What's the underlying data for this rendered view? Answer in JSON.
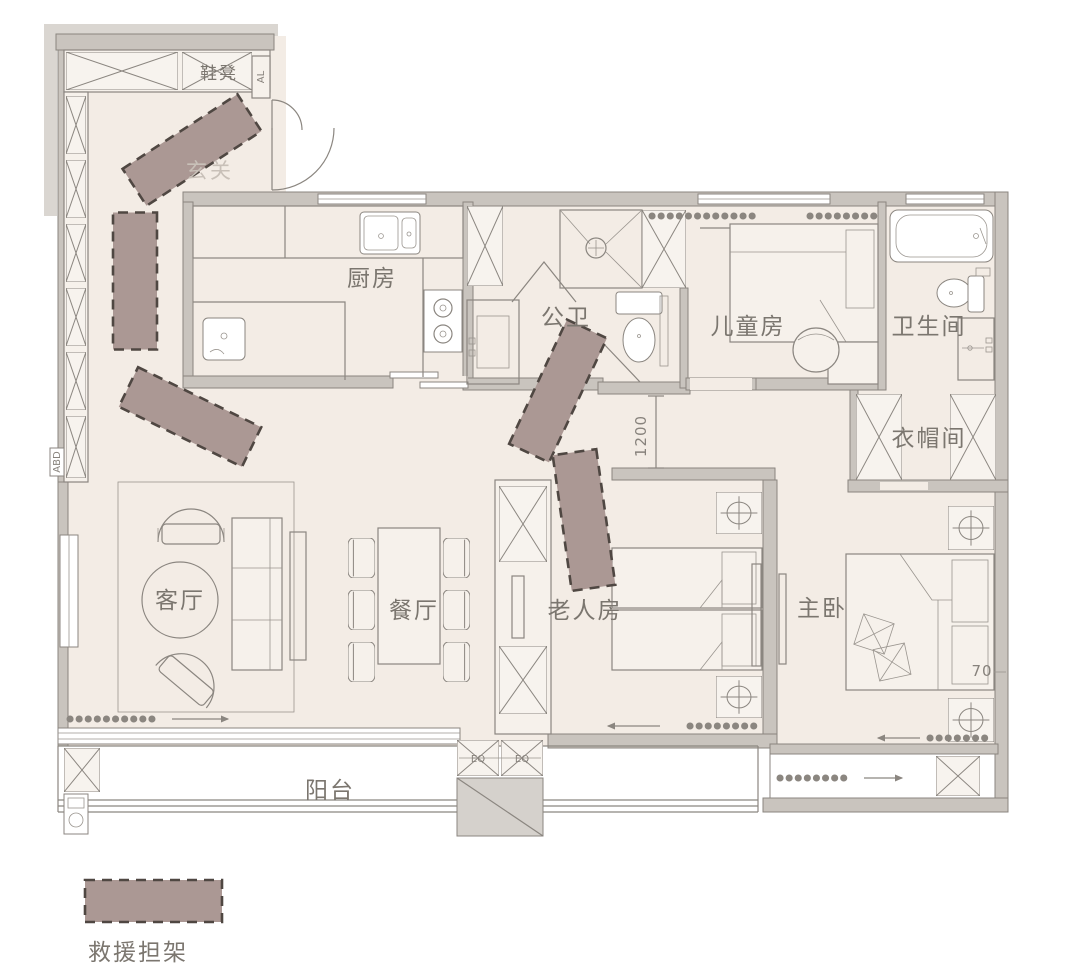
{
  "rooms": {
    "entry": "玄关",
    "shoe_bench": "鞋凳",
    "kitchen": "厨房",
    "guest_bath": "公卫",
    "kids_room": "儿童房",
    "bathroom": "卫生间",
    "cloakroom": "衣帽间",
    "living_room": "客厅",
    "dining_room": "餐厅",
    "elderly_room": "老人房",
    "master_bedroom": "主卧",
    "balcony": "阳台"
  },
  "annotations": {
    "corridor_width": "1200",
    "bed_clearance": "70",
    "eq_left": "EQ",
    "eq_right": "EQ",
    "panel_label": "ABD",
    "door_label": "AL"
  },
  "legend": {
    "stretcher_label": "救援担架"
  },
  "colors": {
    "stretcher_fill": "#ab9894",
    "stretcher_border": "#4f4742",
    "floor": "#f3ece5",
    "wall_fill": "#c9c4be",
    "wall_stroke": "#8a857f",
    "line": "#8b8680",
    "label_text": "#7b766f"
  }
}
